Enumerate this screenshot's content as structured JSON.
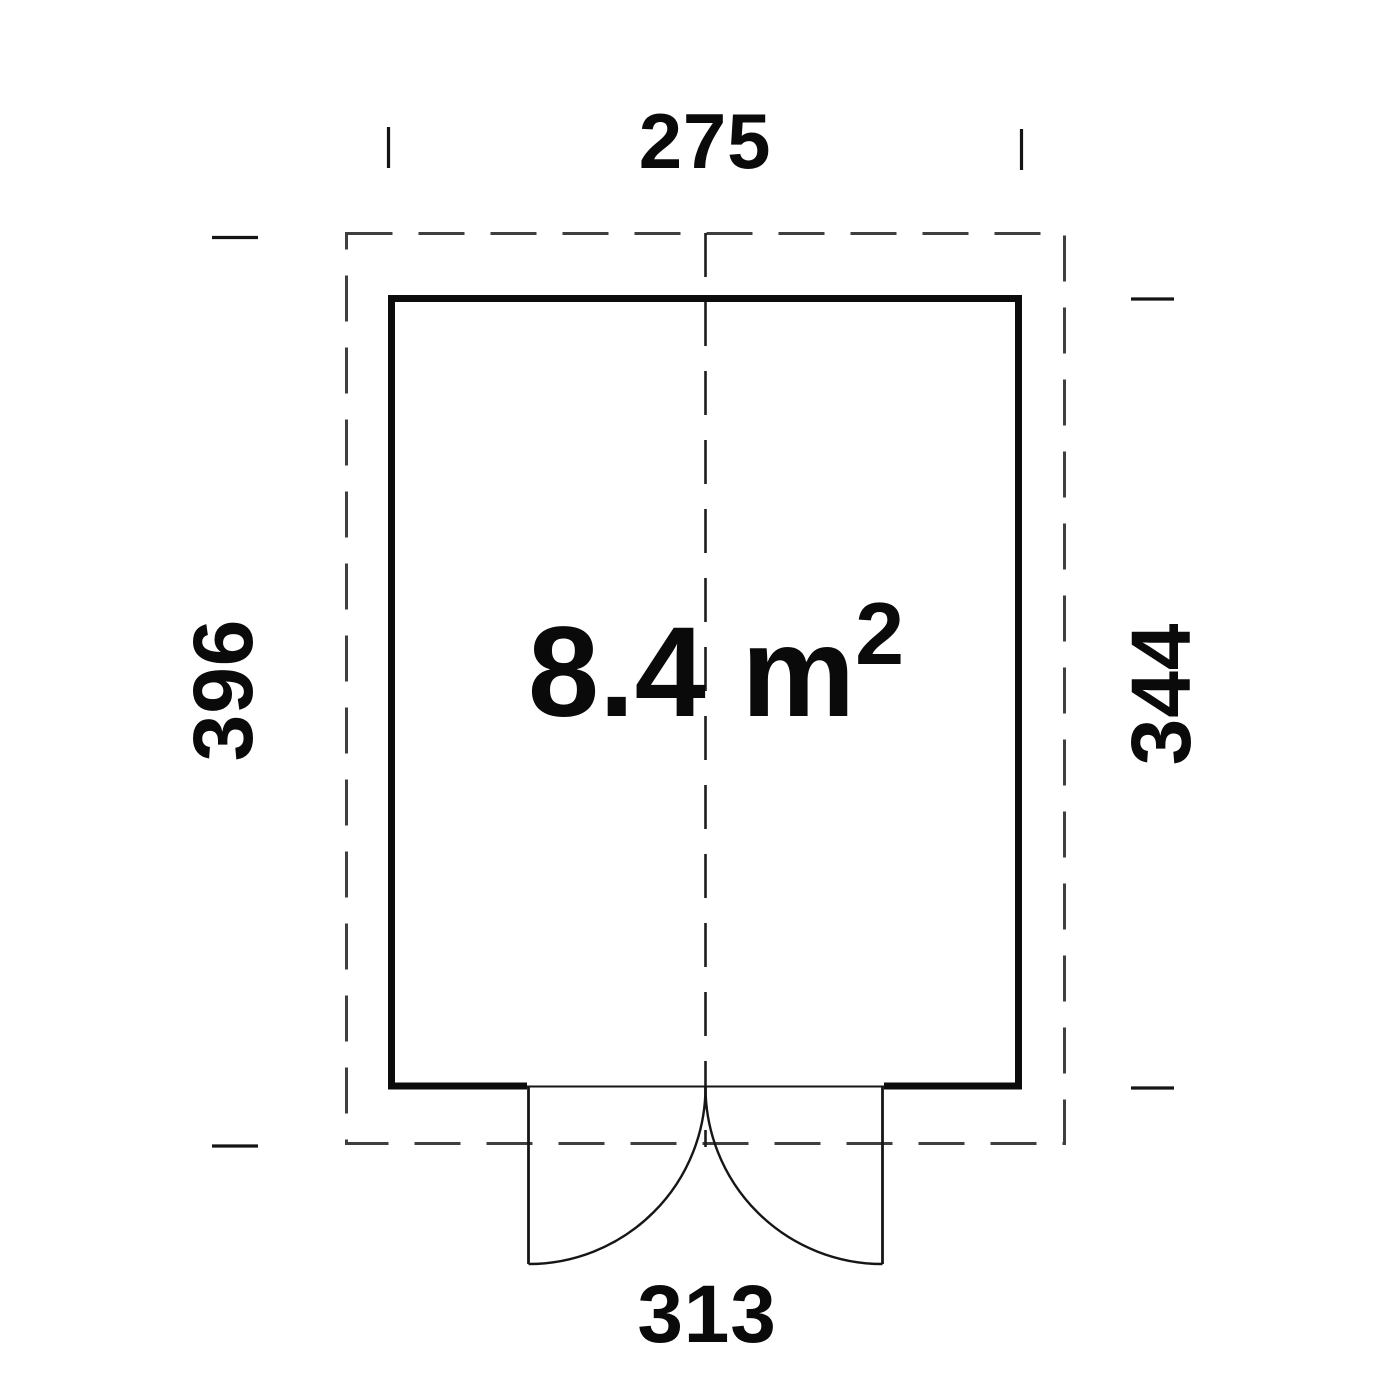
{
  "drawing": {
    "type": "floor-plan",
    "area_label": {
      "value": "8.4 m",
      "superscript": "2"
    },
    "dimensions": {
      "top_width": "275",
      "left_height": "396",
      "right_height": "344",
      "bottom_width": "313"
    },
    "features": {
      "door": "double-outward-swing-door-bottom-center"
    },
    "colors": {
      "background": "#ffffff",
      "wall": "#0c0c0c",
      "dashed_outline": "#3f3f3f",
      "centerline": "#1c1c1c",
      "door_line": "#161616",
      "tick": "#141414",
      "text": "#0a0a0a"
    }
  }
}
